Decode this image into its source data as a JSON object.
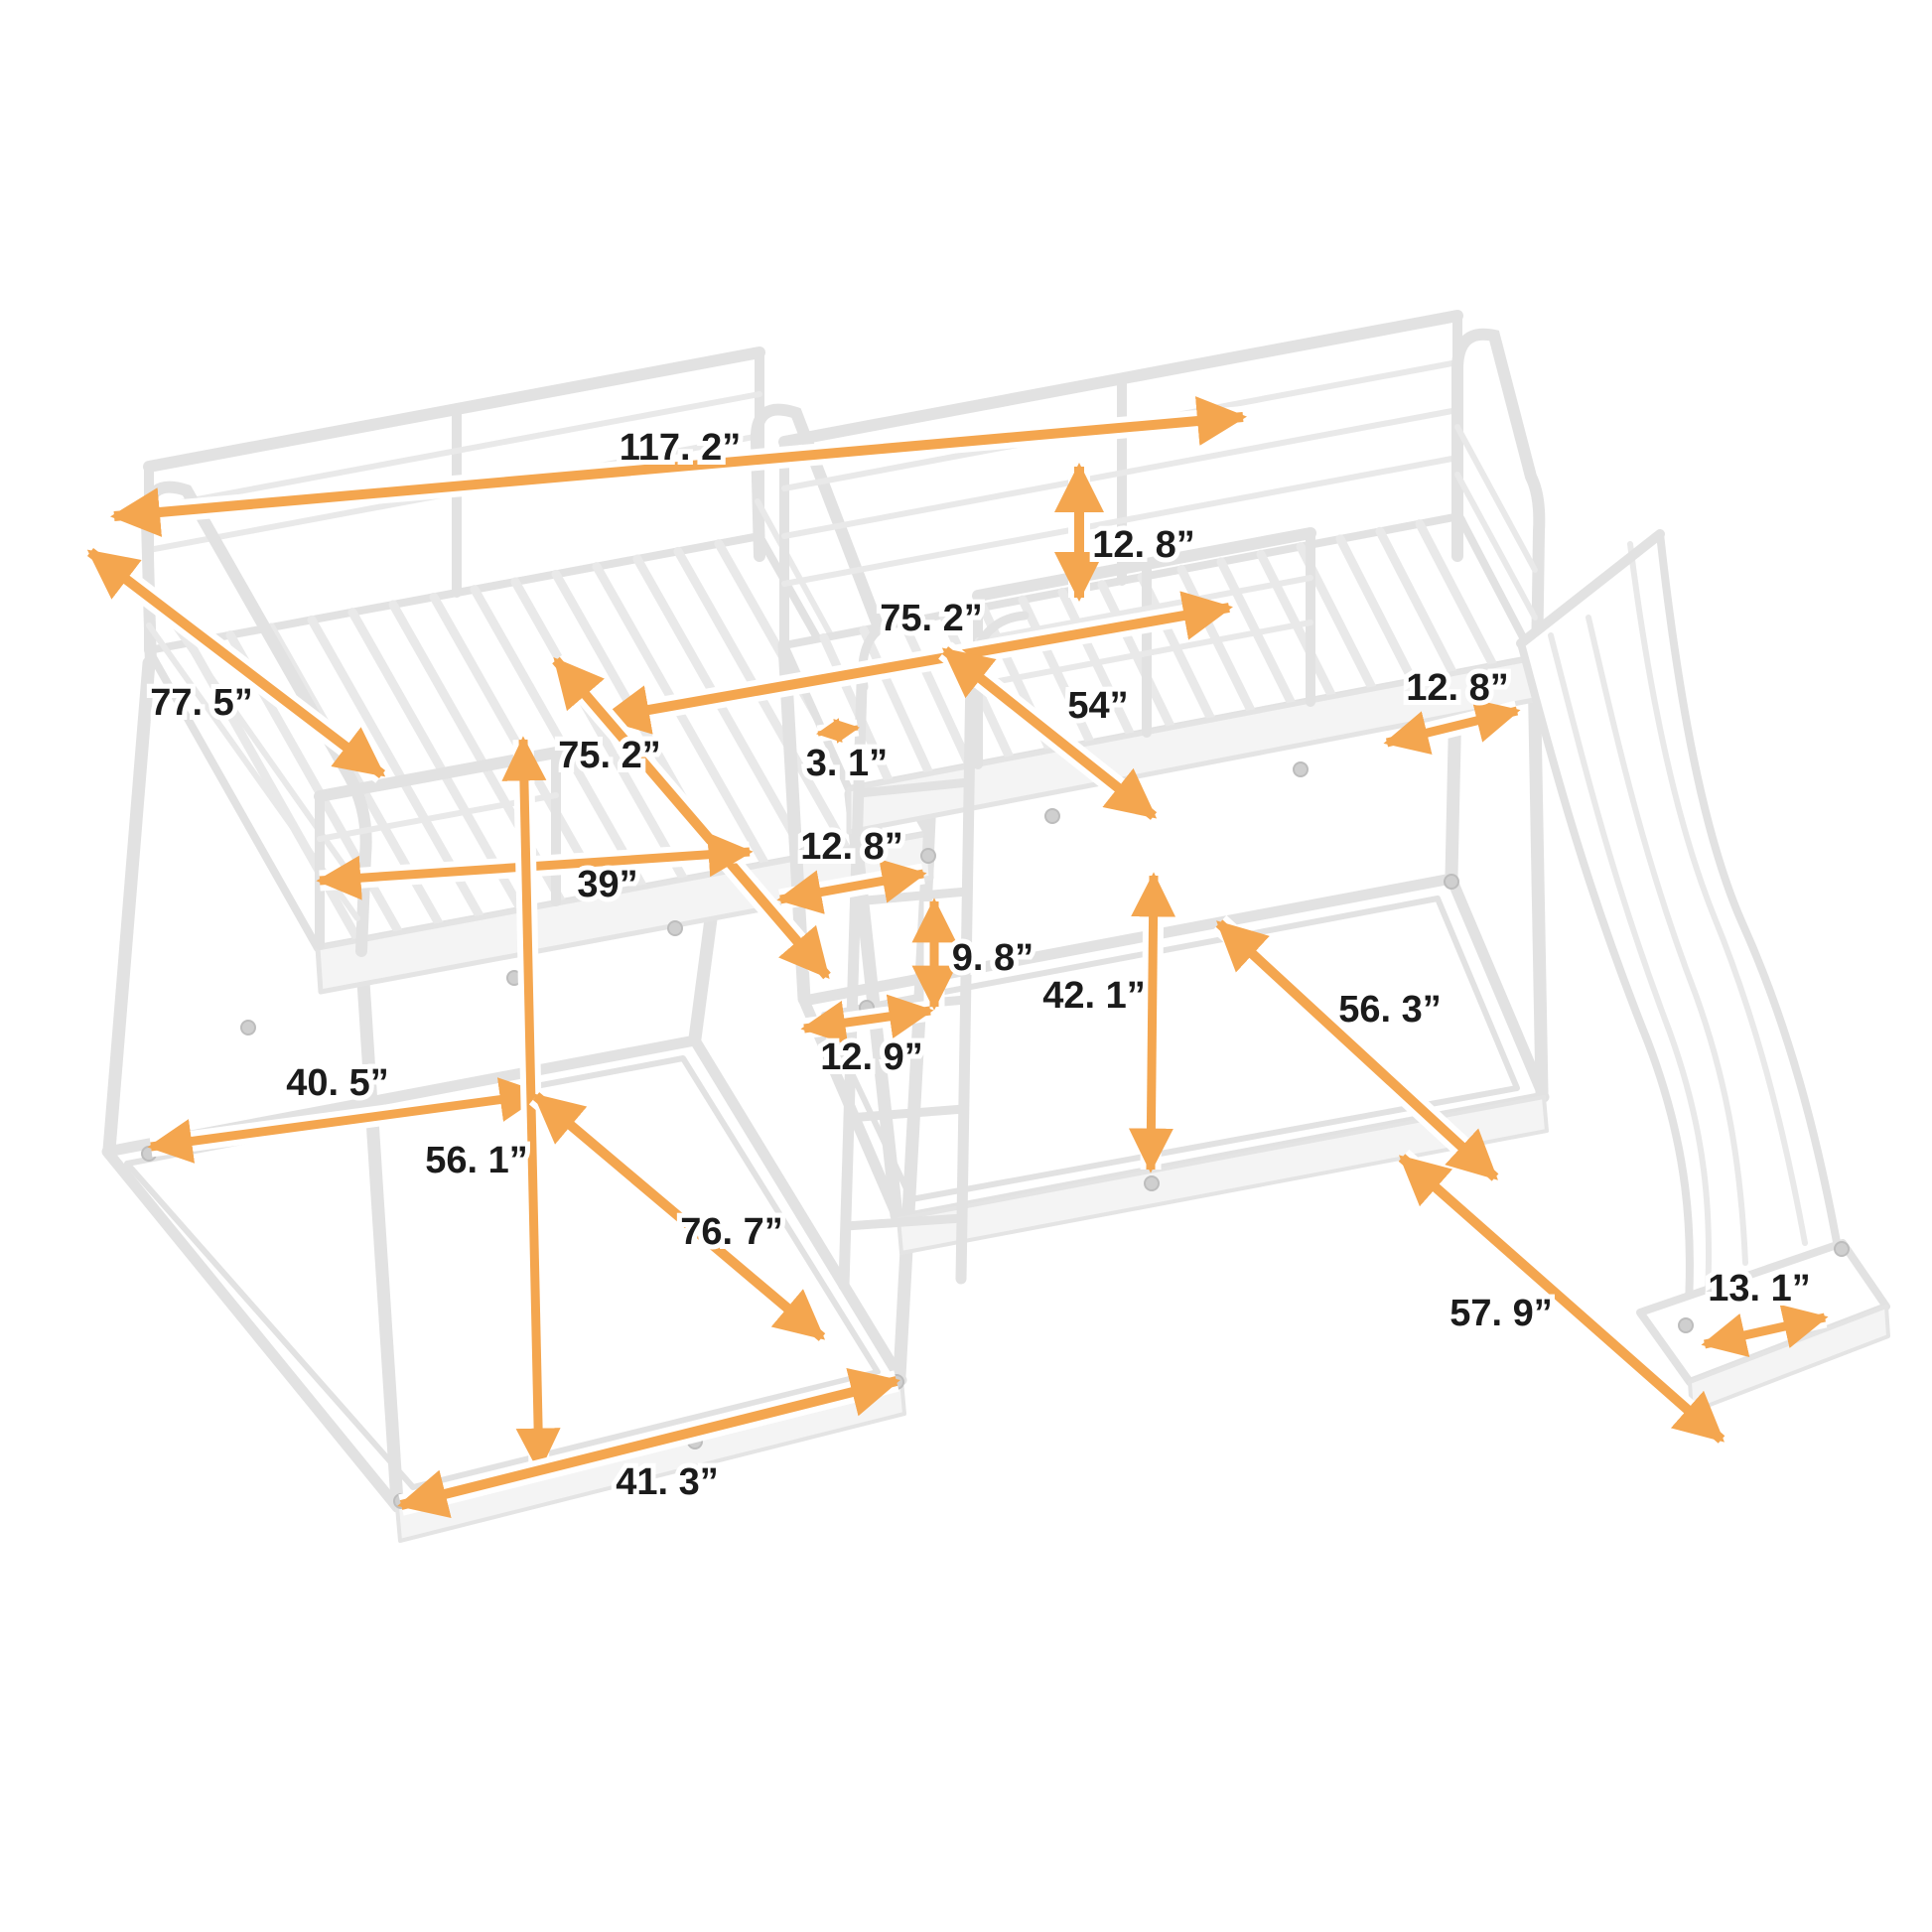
{
  "diagram": {
    "type": "product-dimension-diagram",
    "subject": "L-shaped quad bunk bed with ladder and slide",
    "unit": "inches",
    "background_color": "#ffffff",
    "arrow_color": "#F4A64F",
    "label_color": "#1b1b1b",
    "frame_color": "#e2e2e2"
  },
  "dimensions": {
    "overall_length": {
      "label": "117. 2”",
      "value": 117.2
    },
    "upper_rail_height": {
      "label": "12. 8”",
      "value": 12.8
    },
    "full_bed_length": {
      "label": "75. 2”",
      "value": 75.2
    },
    "full_bed_width": {
      "label": "54”",
      "value": 54
    },
    "slide_top_width": {
      "label": "12. 8”",
      "value": 12.8
    },
    "left_bed_length": {
      "label": "77. 5”",
      "value": 77.5
    },
    "ladder_gap": {
      "label": "3. 1”",
      "value": 3.1
    },
    "twin_bed_length": {
      "label": "75. 2”",
      "value": 75.2
    },
    "ladder_offset": {
      "label": "12. 8”",
      "value": 12.8
    },
    "twin_bed_width": {
      "label": "39”",
      "value": 39
    },
    "ladder_rung_spacing": {
      "label": "9. 8”",
      "value": 9.8
    },
    "ladder_width": {
      "label": "12. 9”",
      "value": 12.9
    },
    "under_bed_clearance": {
      "label": "42. 1”",
      "value": 42.1
    },
    "lower_frame_length": {
      "label": "56. 3”",
      "value": 56.3
    },
    "lower_frame_width_back": {
      "label": "40. 5”",
      "value": 40.5
    },
    "left_bed_height": {
      "label": "56. 1”",
      "value": 56.1
    },
    "lower_frame_diagonal": {
      "label": "76. 7”",
      "value": 76.7
    },
    "lower_frame_front_width": {
      "label": "41. 3”",
      "value": 41.3
    },
    "slide_length": {
      "label": "57. 9”",
      "value": 57.9
    },
    "slide_width": {
      "label": "13. 1”",
      "value": 13.1
    }
  }
}
